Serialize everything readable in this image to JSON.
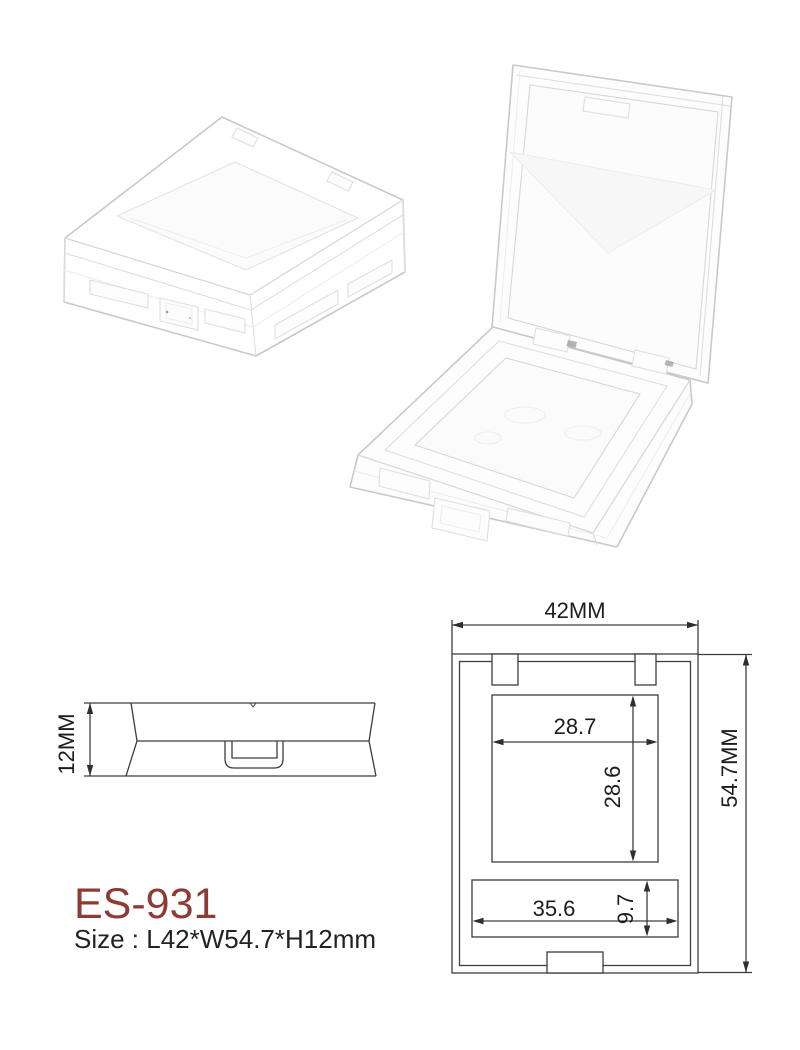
{
  "product": {
    "model": "ES-931",
    "size": "Size : L42*W54.7*H12mm",
    "model_color": "#8e3b35"
  },
  "side_view": {
    "height": "12MM"
  },
  "top_view": {
    "width": "42MM",
    "height": "54.7MM",
    "pan_width": "28.7",
    "pan_height": "28.6",
    "well_width": "35.6",
    "well_height": "9.7"
  }
}
